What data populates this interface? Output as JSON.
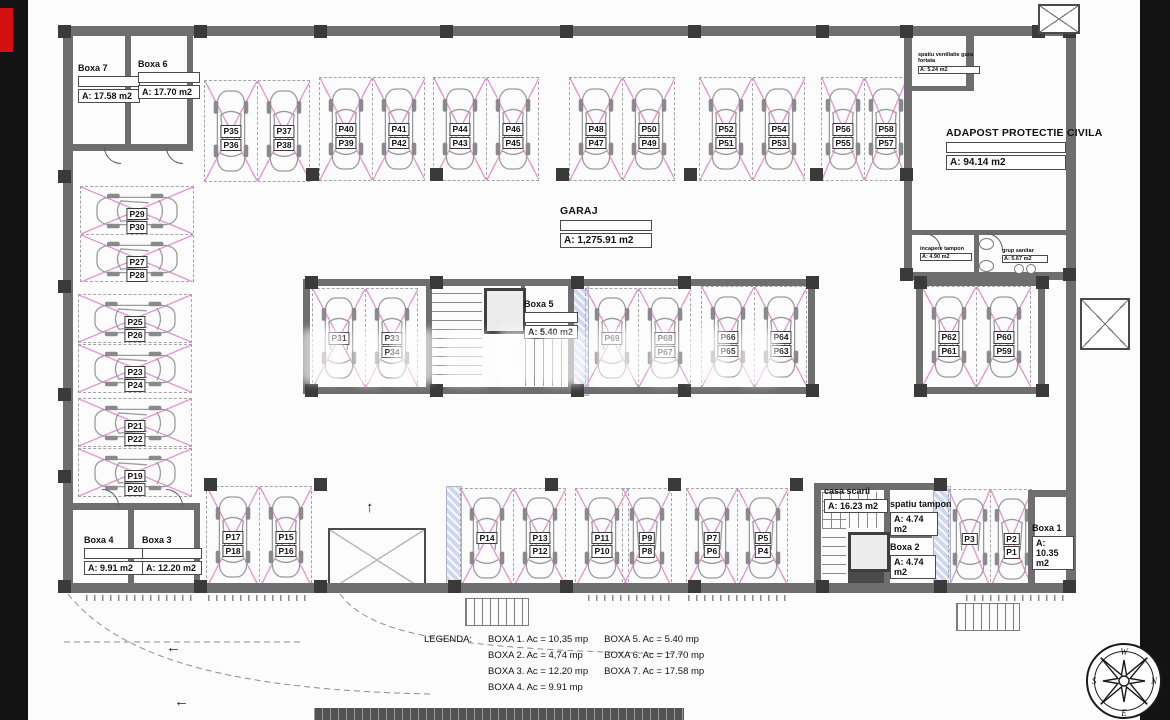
{
  "colors": {
    "background": "#131313",
    "badge_red": "#d40f0f",
    "stall_pink": "#e49ad6",
    "wall_grey": "#6e6e6e"
  },
  "compass": {
    "top": "W",
    "right": "N",
    "bottom": "E",
    "left": "S"
  },
  "legend": {
    "title": "LEGENDA:",
    "column1": [
      "BOXA 1. Ac = 10,35 mp",
      "BOXA 2. Ac = 4,74 mp",
      "BOXA 3. Ac = 12.20 mp",
      "BOXA 4. Ac = 9.91 mp"
    ],
    "column2": [
      "BOXA 5. Ac = 5.40 mp",
      "BOXA 6. Ac = 17.70 mp",
      "BOXA 7. Ac = 17.58 mp"
    ]
  },
  "rooms": [
    {
      "id": "boxa-7",
      "x": 50,
      "y": 64,
      "w": 62,
      "title": "Boxa 7",
      "area": "A: 17.58 m2",
      "empty": true
    },
    {
      "id": "boxa-6",
      "x": 110,
      "y": 60,
      "w": 62,
      "title": "Boxa 6",
      "area": "A: 17.70 m2",
      "empty": true
    },
    {
      "id": "garaj",
      "x": 532,
      "y": 206,
      "w": 92,
      "title": "GARAJ",
      "area": "A: 1,275.91 m2",
      "empty": true,
      "big": true
    },
    {
      "id": "adapost-protectie-civila",
      "x": 918,
      "y": 128,
      "w": 120,
      "title": "ADAPOST PROTECTIE CIVILA",
      "area": "A: 94.14 m2",
      "empty": true,
      "big": true
    },
    {
      "id": "spatiu-ventilatie",
      "x": 890,
      "y": 52,
      "w": 62,
      "title": "spatiu ventilatie gura fortata",
      "area": "A: 5.24 m2",
      "tiny": true
    },
    {
      "id": "incapere-tampon",
      "x": 892,
      "y": 246,
      "w": 52,
      "title": "incapere tampon",
      "area": "A: 4.90 m2",
      "tiny": true
    },
    {
      "id": "grup-sanitar",
      "x": 974,
      "y": 248,
      "w": 46,
      "title": "grup sanitar",
      "area": "A: 5.67 m2",
      "tiny": true
    },
    {
      "id": "boxa-5",
      "x": 496,
      "y": 300,
      "w": 54,
      "title": "Boxa 5",
      "area": "A: 5.40 m2",
      "empty": true
    },
    {
      "id": "casa-scarii",
      "x": 796,
      "y": 487,
      "w": 64,
      "title": "casa scarii",
      "area": "A: 16.23 m2"
    },
    {
      "id": "spatiu-tampon",
      "x": 862,
      "y": 500,
      "w": 48,
      "title": "spatiu tampon",
      "area": "A: 4.74 m2"
    },
    {
      "id": "boxa-2",
      "x": 862,
      "y": 543,
      "w": 46,
      "title": "Boxa 2",
      "area": "A: 4.74 m2"
    },
    {
      "id": "boxa-1",
      "x": 1004,
      "y": 524,
      "w": 42,
      "title": "Boxa 1",
      "area": "A: 10.35 m2"
    },
    {
      "id": "boxa-4",
      "x": 56,
      "y": 536,
      "w": 60,
      "title": "Boxa 4",
      "area": "A: 9.91 m2",
      "empty": true
    },
    {
      "id": "boxa-3",
      "x": 114,
      "y": 536,
      "w": 60,
      "title": "Boxa 3",
      "area": "A: 12.20 m2",
      "empty": true
    }
  ],
  "stall_groups": [
    {
      "x": 176,
      "y": 80,
      "h": 100,
      "stalls": [
        [
          "P35",
          "P36"
        ],
        [
          "P37",
          "P38"
        ]
      ]
    },
    {
      "x": 291,
      "y": 77,
      "h": 102,
      "stalls": [
        [
          "P40",
          "P39"
        ],
        [
          "P41",
          "P42"
        ]
      ]
    },
    {
      "x": 405,
      "y": 77,
      "h": 102,
      "stalls": [
        [
          "P44",
          "P43"
        ],
        [
          "P46",
          "P45"
        ]
      ]
    },
    {
      "x": 541,
      "y": 77,
      "h": 102,
      "stalls": [
        [
          "P48",
          "P47"
        ],
        [
          "P50",
          "P49"
        ]
      ]
    },
    {
      "x": 671,
      "y": 77,
      "h": 102,
      "stalls": [
        [
          "P52",
          "P51"
        ],
        [
          "P54",
          "P53"
        ]
      ]
    },
    {
      "x": 793,
      "y": 77,
      "h": 102,
      "w": 42,
      "stalls": [
        [
          "P56",
          "P55"
        ],
        [
          "P58",
          "P57"
        ]
      ]
    },
    {
      "x": 284,
      "y": 288,
      "h": 98,
      "stalls": [
        [
          "P31"
        ],
        [
          "P33",
          "P34"
        ]
      ]
    },
    {
      "x": 557,
      "y": 288,
      "h": 98,
      "stalls": [
        [
          "P69"
        ],
        [
          "P68",
          "P67"
        ]
      ]
    },
    {
      "x": 673,
      "y": 286,
      "h": 100,
      "stalls": [
        [
          "P66",
          "P65"
        ],
        [
          "P64",
          "P63"
        ]
      ]
    },
    {
      "x": 893,
      "y": 286,
      "h": 100,
      "w": 54,
      "stalls": [
        [
          "P62",
          "P61"
        ],
        [
          "P60",
          "P59"
        ]
      ]
    },
    {
      "x": 52,
      "y": 186,
      "dir": "left",
      "stalls": [
        [
          "P29",
          "P30"
        ],
        [
          "P27",
          "P28"
        ]
      ]
    },
    {
      "x": 50,
      "y": 294,
      "dir": "left",
      "stalls": [
        [
          "P25",
          "P26"
        ]
      ]
    },
    {
      "x": 50,
      "y": 344,
      "dir": "left",
      "stalls": [
        [
          "P23",
          "P24"
        ]
      ]
    },
    {
      "x": 50,
      "y": 398,
      "dir": "left",
      "stalls": [
        [
          "P21",
          "P22"
        ]
      ]
    },
    {
      "x": 50,
      "y": 448,
      "dir": "left",
      "stalls": [
        [
          "P19",
          "P20"
        ]
      ]
    },
    {
      "x": 178,
      "y": 486,
      "h": 100,
      "stalls": [
        [
          "P17",
          "P18"
        ],
        [
          "P15",
          "P16"
        ]
      ]
    },
    {
      "x": 432,
      "y": 488,
      "h": 97,
      "stalls": [
        [
          "P14"
        ],
        [
          "P13",
          "P12"
        ]
      ]
    },
    {
      "x": 547,
      "y": 488,
      "h": 97,
      "stalls": [
        [
          "P11",
          "P10"
        ]
      ]
    },
    {
      "x": 594,
      "y": 488,
      "h": 97,
      "w": 48,
      "stalls": [
        [
          "P9",
          "P8"
        ]
      ]
    },
    {
      "x": 658,
      "y": 488,
      "h": 97,
      "w": 50,
      "stalls": [
        [
          "P7",
          "P6"
        ],
        [
          "P5",
          "P4"
        ]
      ]
    },
    {
      "x": 920,
      "y": 489,
      "h": 97,
      "w": 41,
      "stalls": [
        [
          "P3"
        ],
        [
          "P2",
          "P1"
        ]
      ]
    }
  ]
}
